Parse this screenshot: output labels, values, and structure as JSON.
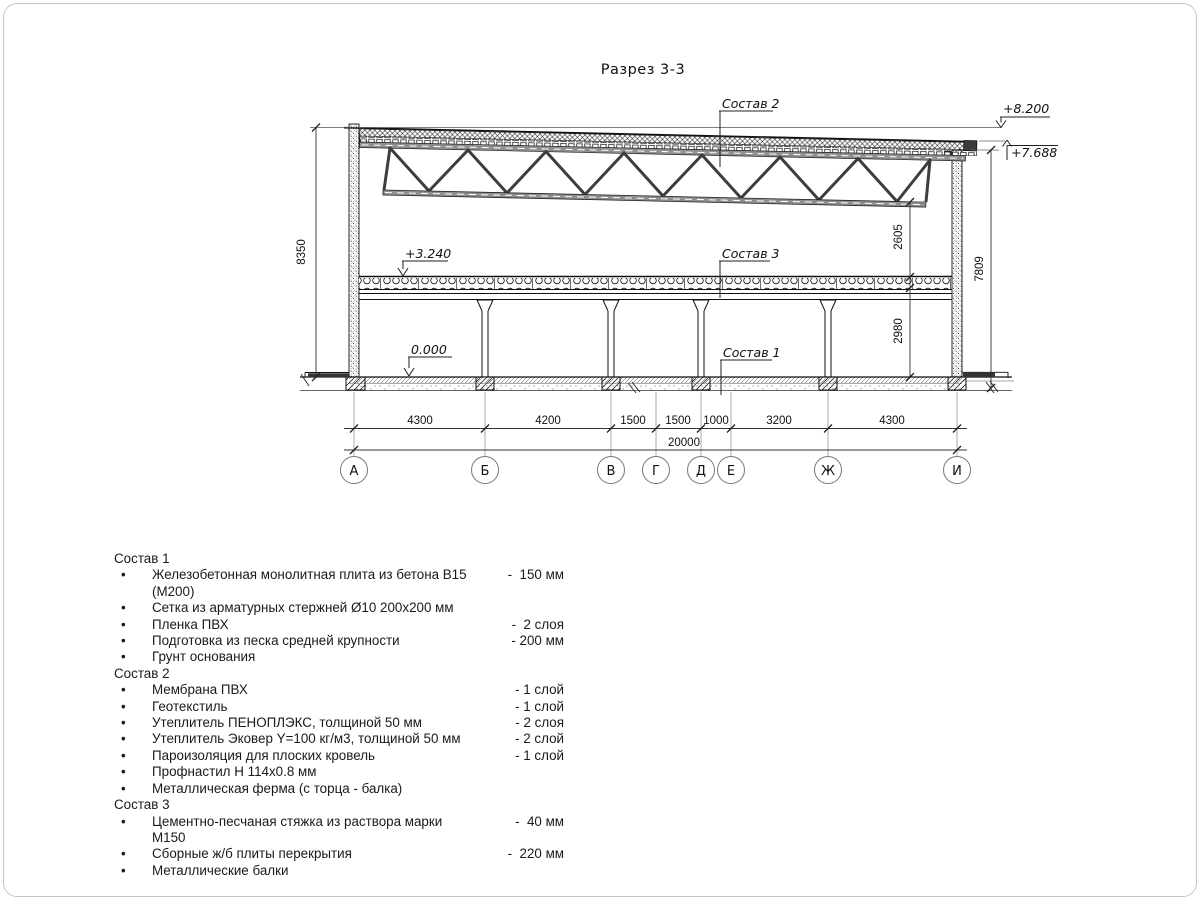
{
  "title": "Разрез 3-3",
  "drawing": {
    "labels": {
      "sostav1": "Состав 1",
      "sostav2": "Состав 2",
      "sostav3": "Состав 3"
    },
    "elevations": {
      "top": "+8.200",
      "roof_right": "+7.688",
      "floor": "+3.240",
      "ground": "0.000"
    },
    "dims_vertical": {
      "left": "8350",
      "right_outer": "7809",
      "upper": "2605",
      "lower": "2980"
    },
    "dims_bottom": {
      "segments": [
        "4300",
        "4200",
        "1500",
        "1500",
        "1000",
        "3200",
        "4300"
      ],
      "total": "20000"
    },
    "axes": [
      "А",
      "Б",
      "В",
      "Г",
      "Д",
      "Е",
      "Ж",
      "И"
    ]
  },
  "compositions": [
    {
      "title": "Состав 1",
      "items": [
        {
          "text": "Железобетонная монолитная плита из бетона В15 (М200)",
          "value": "-  150 мм"
        },
        {
          "text": "Сетка из арматурных стержней Ø10 200х200 мм",
          "value": ""
        },
        {
          "text": "Пленка ПВХ",
          "value": "-  2 слоя"
        },
        {
          "text": "Подготовка из песка средней крупности",
          "value": "- 200 мм"
        },
        {
          "text": "Грунт основания",
          "value": ""
        }
      ]
    },
    {
      "title": "Состав 2",
      "items": [
        {
          "text": "Мембрана ПВХ",
          "value": "- 1 слой"
        },
        {
          "text": "Геотекстиль",
          "value": "- 1 слой"
        },
        {
          "text": "Утеплитель ПЕНОПЛЭКС, толщиной 50 мм",
          "value": "- 2 слоя"
        },
        {
          "text": "Утеплитель Эковер Y=100 кг/м3, толщиной 50 мм",
          "value": "- 2 слой"
        },
        {
          "text": "Пароизоляция для плоских кровель",
          "value": "- 1 слой"
        },
        {
          "text": "Профнастил Н 114х0.8 мм",
          "value": ""
        },
        {
          "text": "Металлическая ферма (с торца - балка)",
          "value": ""
        }
      ]
    },
    {
      "title": "Состав 3",
      "items": [
        {
          "text": "Цементно-песчаная стяжка из раствора марки М150",
          "value": "-  40 мм"
        },
        {
          "text": "Сборные ж/б плиты перекрытия",
          "value": "-  220 мм"
        },
        {
          "text": "Металлические балки",
          "value": ""
        }
      ]
    }
  ]
}
